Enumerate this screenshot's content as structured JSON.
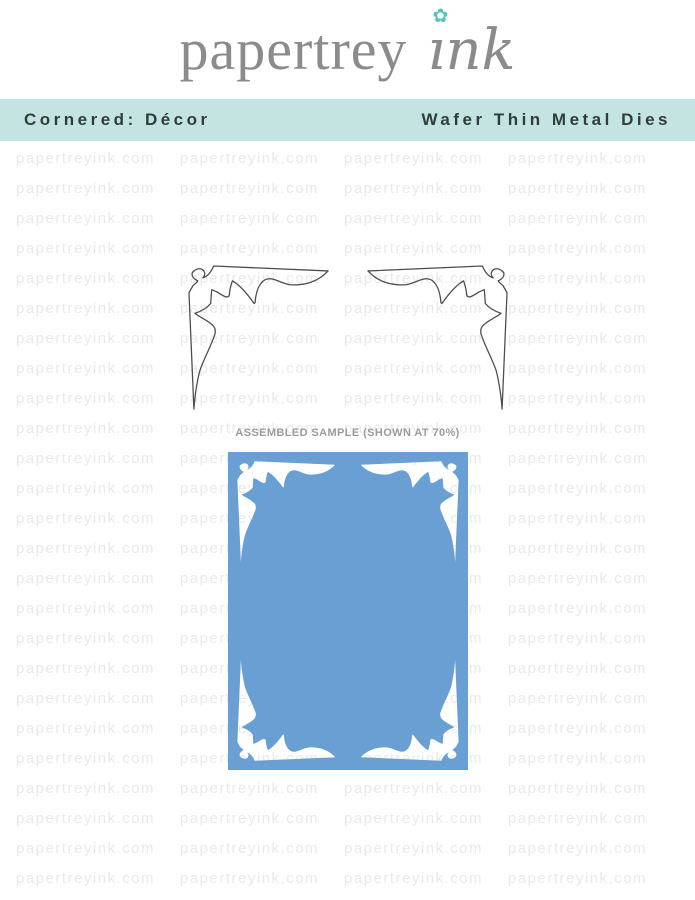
{
  "logo": {
    "word1": "papertrey",
    "word2": "ink",
    "word2_display": "ınk",
    "flower_icon": "flower-icon",
    "text_color": "#8b8b8b",
    "flower_color": "#52c4bf"
  },
  "banner": {
    "left_label": "Cornered: Décor",
    "right_label": "Wafer Thin Metal Dies",
    "bg_color": "#c3e4e1",
    "text_color": "#2f3e3d"
  },
  "watermark": {
    "text": "papertreyink.com",
    "color": "#e9e9e9",
    "rows": 25,
    "cols": 4
  },
  "dies": {
    "count": 2,
    "outline_color": "#4d4d4d",
    "fill_color": "#ffffff"
  },
  "sample": {
    "caption": "ASSEMBLED SAMPLE (SHOWN AT 70%)",
    "caption_color": "#9b9b9b",
    "card_color": "#699fd2",
    "corner_color": "#ffffff"
  }
}
